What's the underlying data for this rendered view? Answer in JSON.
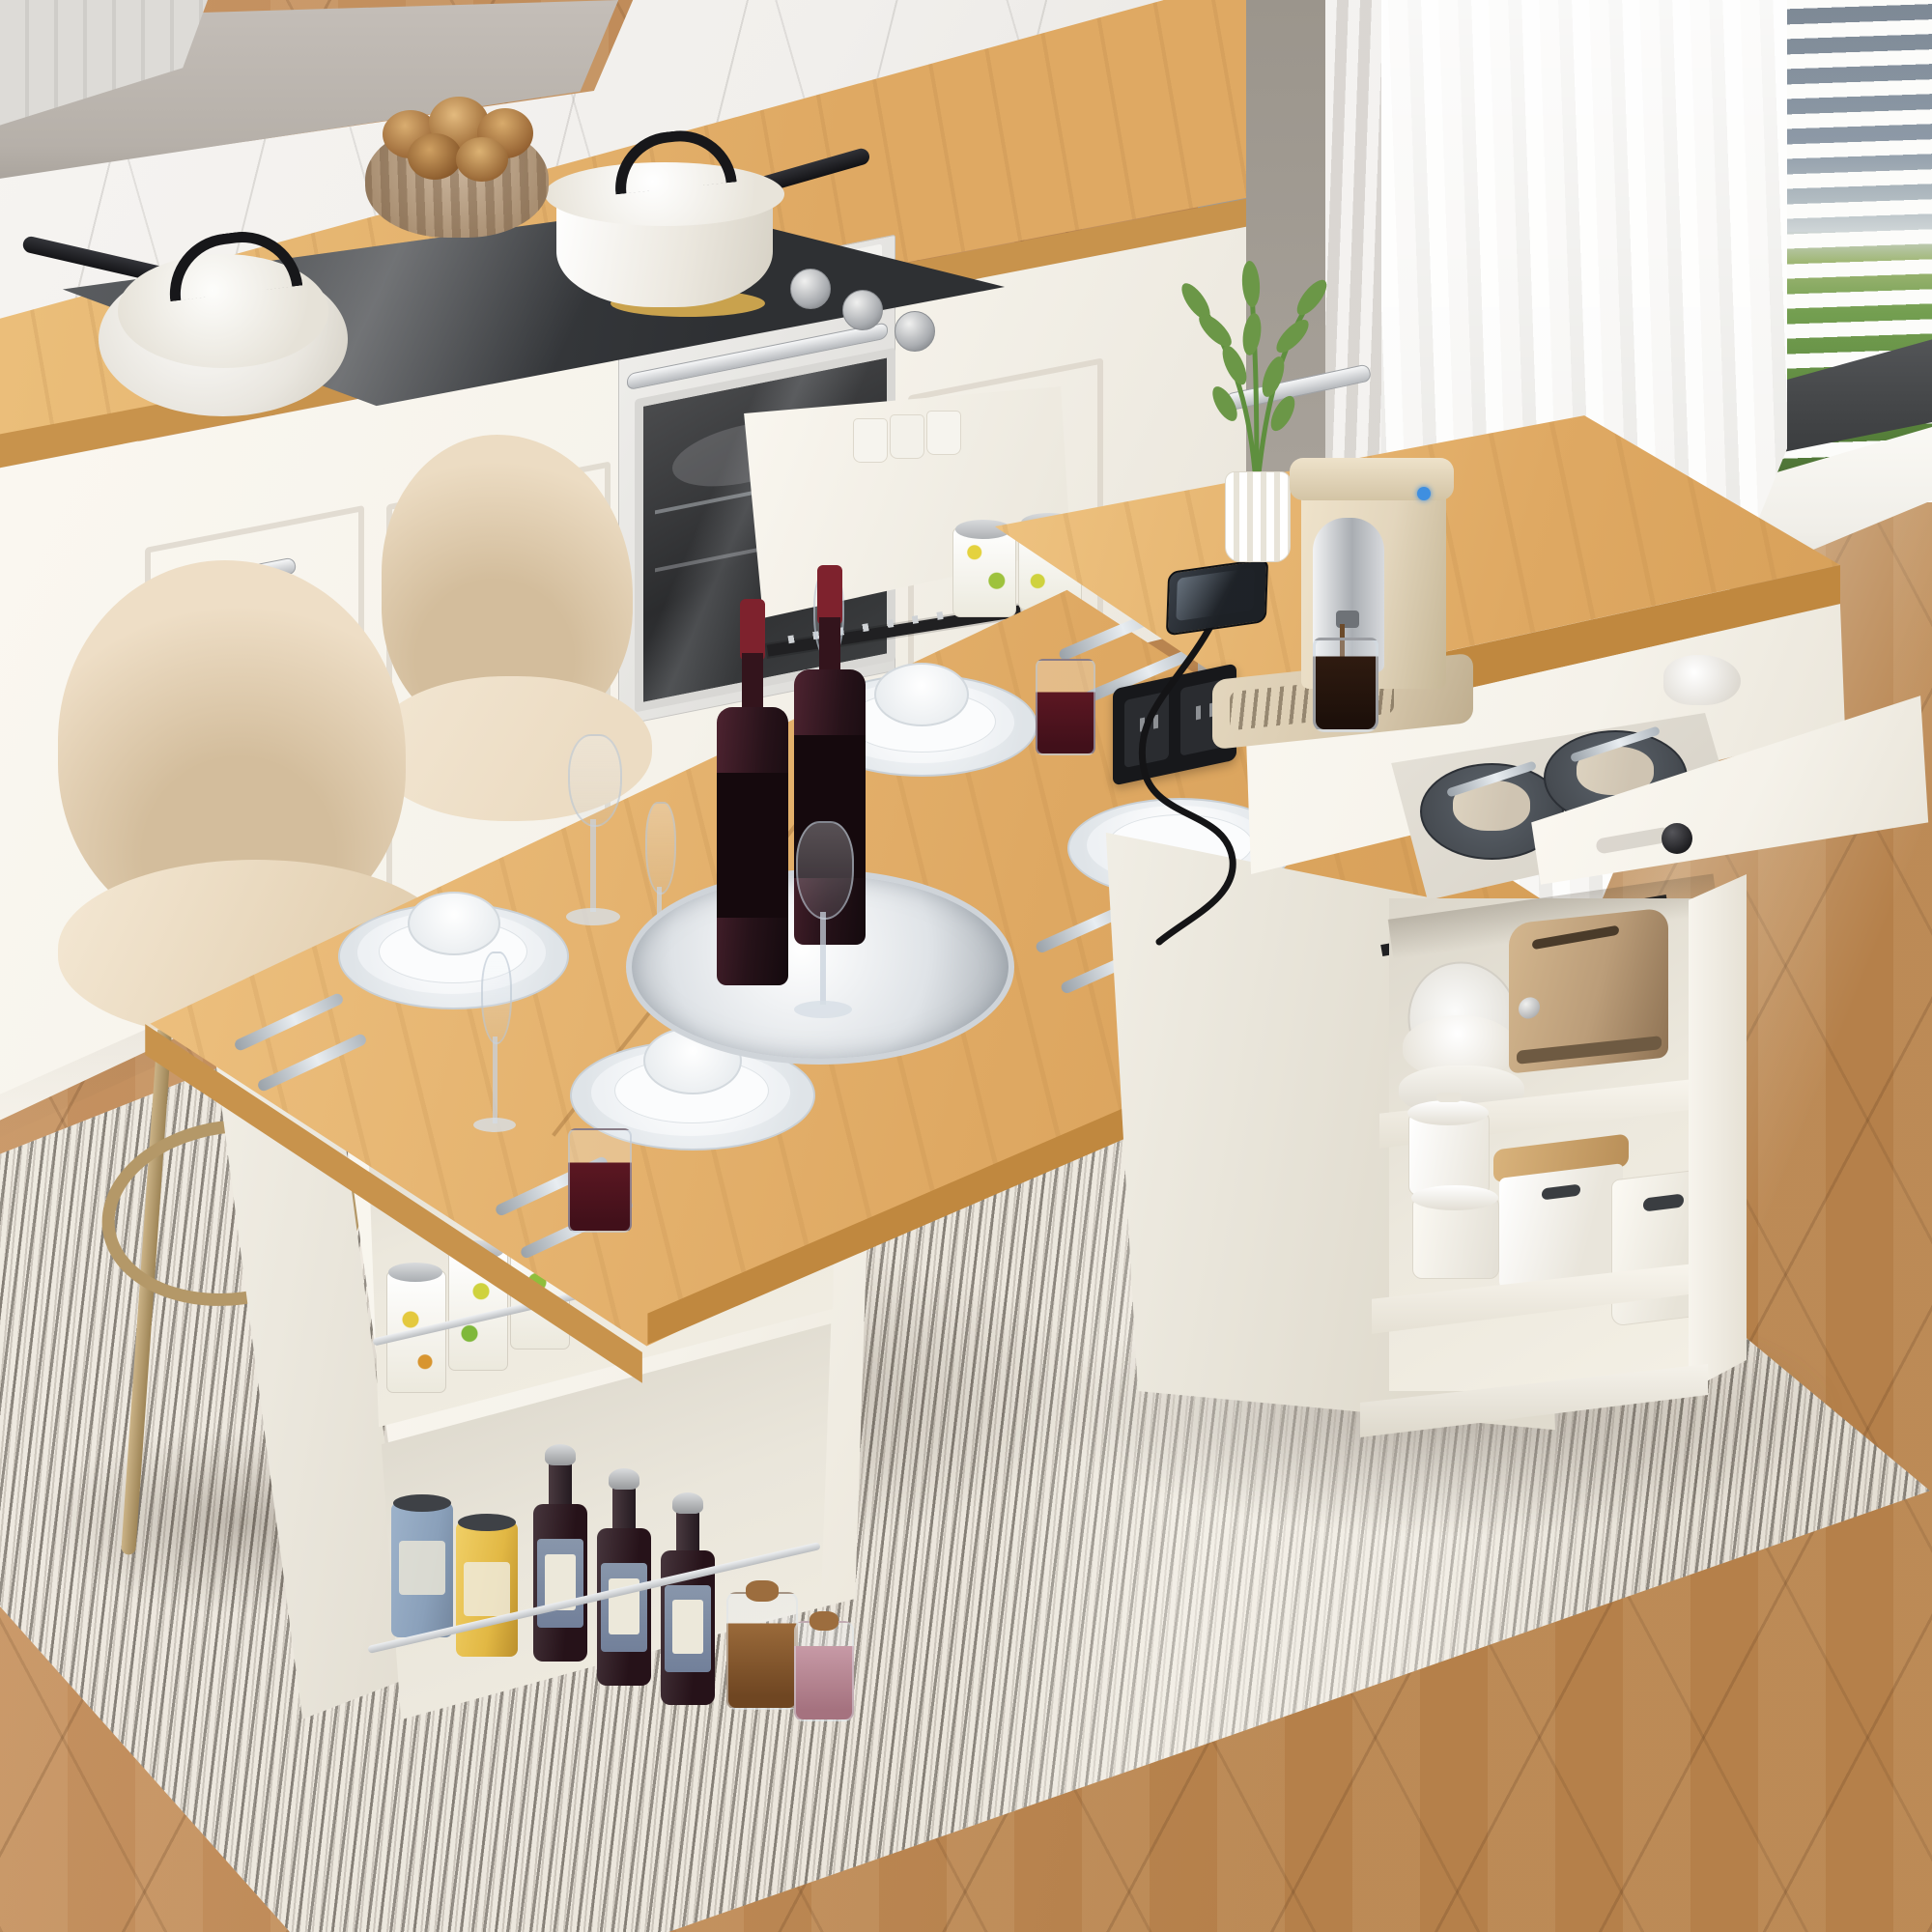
{
  "meta": {
    "title": "White kitchen with extendable island dining table",
    "style": "photorealistic product render recreation"
  },
  "colors": {
    "wood-light": "#ecc07c",
    "wood-mid": "#dfa963",
    "wood-dark": "#c8934c",
    "wood-edge": "#c0883f",
    "floor-light": "#c79464",
    "floor-mid": "#b5804a",
    "floor-seam": "#8e6236",
    "rug-base": "#ebe6dc",
    "rug-stripe": "#4e473f",
    "rug-light": "#f6f3ec",
    "cab-white": "#f5f2ea",
    "cab-shadow": "#e6e1d6",
    "cab-line": "#d8d2c6",
    "marble-base": "#f1efec",
    "marble-vein": "#cfccc8",
    "hood-gray": "#b6b0a9",
    "wall-taupe": "#a7a199",
    "curtain-light": "#f7f6f4",
    "curtain-shade": "#dcd9d5",
    "sky-blue": "#76828f",
    "sky-light": "#ccd3d5",
    "grass-green": "#6d9a48",
    "grass-dark": "#4f7c30",
    "frame-dark": "#46484a",
    "sill-white": "#f0eee8",
    "steel": "#c9cbce",
    "black": "#1c1c1e",
    "chair-beige": "#ecdcc3",
    "chair-shade": "#d3bd9c",
    "gold": "#b49868",
    "plate-white": "#fbfcfd",
    "plate-gray": "#dfe4e8",
    "dark-plate": "#474c52",
    "napkin": "#cfc4b2",
    "bottle-dark": "#261219",
    "bottle-cap": "#7e222d",
    "wine-red": "#5c1722",
    "can-blue": "#8aa0ba",
    "can-yellow": "#e2b844",
    "toaster-tan": "#bb9d79",
    "coffee-cream": "#e3d6bd",
    "coffee-dark": "#2f1b10",
    "tray-beige": "#d8c9ae",
    "leaf-green": "#6b9747",
    "outlet-black": "#17181b"
  },
  "scene": {
    "room": "modern white kitchen, high-angle three-quarter view",
    "left_counter": {
      "items": [
        "covered saute pan",
        "covered saucepan",
        "black induction cooktop",
        "wicker bread basket"
      ],
      "bread_rolls": 5,
      "cooktop_knobs": 3
    },
    "oven": {
      "knobs": 3,
      "handle": "chrome bar",
      "door": "dark glass"
    },
    "window": {
      "treatment": "open horizontal blinds",
      "outside": [
        "blue-gray sky",
        "green lawn"
      ],
      "curtains": "sheer white panels"
    },
    "island": {
      "top": "light oak with white body",
      "features": [
        "pull-out rear storage tray",
        "open cutlery drawer with plates",
        "built-in power outlet charging phone",
        "coffee machine pouring espresso",
        "potted green plant",
        "open storage shelves"
      ],
      "shelf_items": [
        "bronze toaster",
        "stack of white bowls",
        "lidded white pots",
        "storage bins with wood lids",
        "white basket"
      ]
    },
    "pullout_cans": 2,
    "drawer_plate_stacks": 2,
    "dining_table": {
      "place_settings": 4,
      "centerpiece": [
        "mirrored tray",
        "two wine bottles",
        "wine glass"
      ],
      "glasses": [
        "wine glasses",
        "champagne flutes",
        "tumbler of red wine"
      ]
    },
    "left_base_shelves": {
      "upper": [
        "dotted food tins",
        "white cutlery organizers",
        "chrome rail"
      ],
      "lower": [
        "blue tin",
        "yellow tin",
        "three sauce bottles",
        "two spice jars",
        "chrome rail"
      ]
    },
    "chairs": 2,
    "rug": "ivory rug with charcoal stripes",
    "floor": "chevron oak parquet"
  }
}
